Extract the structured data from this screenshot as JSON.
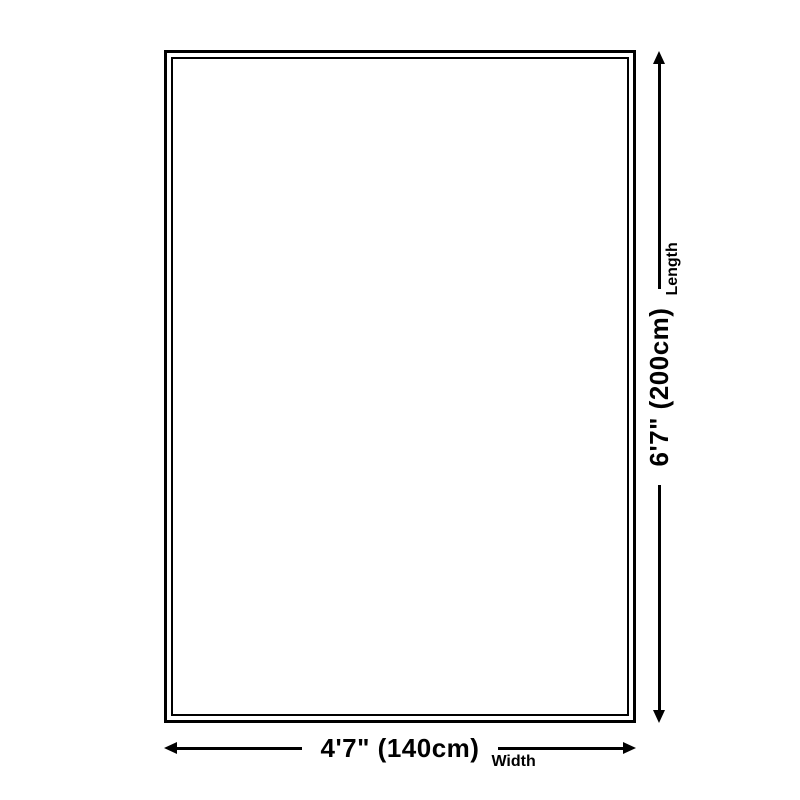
{
  "diagram": {
    "kind": "product-size-diagram",
    "background_color": "#ffffff",
    "line_color": "#000000",
    "text_color": "#000000",
    "product_outline": {
      "shape": "rectangle",
      "border_style": "double",
      "fill": "#ffffff"
    },
    "width": {
      "value": "4'7\" (140cm)",
      "label": "Width",
      "cm": 140
    },
    "length": {
      "value": "6'7\" (200cm)",
      "label": "Length",
      "cm": 200
    }
  }
}
